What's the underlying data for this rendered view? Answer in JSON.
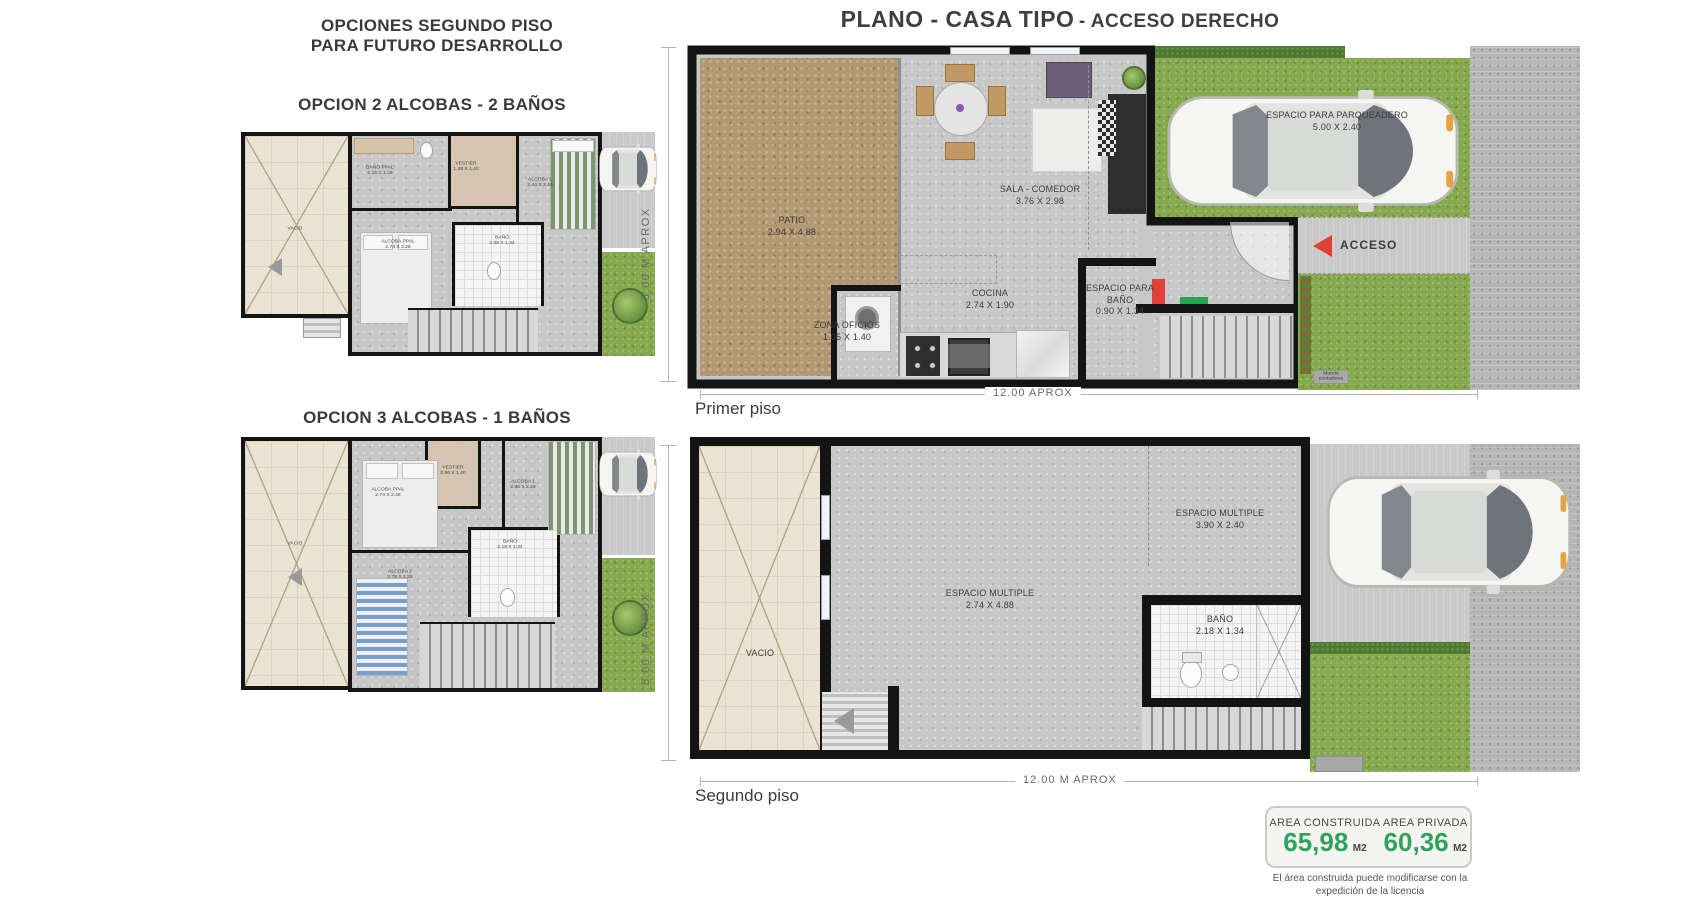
{
  "title": {
    "main": "PLANO - CASA TIPO",
    "sub": "- ACCESO DERECHO"
  },
  "left_panel": {
    "header_line1": "OPCIONES SEGUNDO PISO",
    "header_line2": "PARA FUTURO DESARROLLO",
    "option1": {
      "title": "OPCION 2 ALCOBAS - 2 BAÑOS",
      "rooms": {
        "vacio": {
          "name": "VACIO"
        },
        "bano_ppal": {
          "name": "BAÑO PPAL",
          "dims": "2.16 X 1.28"
        },
        "vestier": {
          "name": "VESTIER",
          "dims": "1.48 X 1.40"
        },
        "alcoba1": {
          "name": "ALCOBA 1",
          "dims": "2.44 X 2.49"
        },
        "alcoba_ppal": {
          "name": "ALCOBA PPAL",
          "dims": "2.74 X 3.28"
        },
        "bano": {
          "name": "BAÑO",
          "dims": "2.08 X 1.34"
        }
      }
    },
    "option2": {
      "title": "OPCION 3 ALCOBAS - 1 BAÑOS",
      "rooms": {
        "vacio": {
          "name": "VACIO"
        },
        "alcoba_ppal": {
          "name": "ALCOBA PPAL",
          "dims": "2.74 X 2.48"
        },
        "vestier": {
          "name": "VESTIER",
          "dims": "0.96 X 1.40"
        },
        "alcoba1": {
          "name": "ALCOBA 1",
          "dims": "2.85 X 2.49"
        },
        "alcoba2": {
          "name": "ALCOBA 2",
          "dims": "2.79 X 2.28"
        },
        "bano": {
          "name": "BAÑO",
          "dims": "2.18 X 1.34"
        }
      }
    }
  },
  "floor1": {
    "label": "Primer piso",
    "dim_horizontal": "12.00 APROX",
    "dim_vertical": "5.00 M APROX",
    "rooms": {
      "patio": {
        "name": "PATIO",
        "dims": "2.94 X 4.88"
      },
      "sala_comedor": {
        "name": "SALA - COMEDOR",
        "dims": "3.76 X 2.98"
      },
      "cocina": {
        "name": "COCINA",
        "dims": "2.74 X 1.90"
      },
      "zona_oficios": {
        "name": "ZONA OFICIOS",
        "dims": "1.05 X 1.40"
      },
      "espacio_bano": {
        "name": "ESPACIO PARA BAÑO",
        "dims": "0.90 X 1.34"
      },
      "parqueadero": {
        "name": "ESPACIO PARA PARQUEADERO",
        "dims": "5.00 X 2.40"
      }
    },
    "acceso_label": "ACCESO",
    "murete_label": "Murete contadores"
  },
  "floor2": {
    "label": "Segundo piso",
    "dim_horizontal": "12.00 M APROX",
    "dim_vertical": "5.00 M APROX",
    "rooms": {
      "vacio": {
        "name": "VACIO"
      },
      "espacio_multiple_1": {
        "name": "ESPACIO MULTIPLE",
        "dims": "2.74 X 4.88"
      },
      "espacio_multiple_2": {
        "name": "ESPACIO MULTIPLE",
        "dims": "3.90 X 2.40"
      },
      "bano": {
        "name": "BAÑO",
        "dims": "2.18 X 1.34"
      }
    }
  },
  "area_summary": {
    "construida_label": "AREA CONSTRUIDA",
    "construida_value": "65,98",
    "construida_unit": "M2",
    "privada_label": "AREA  PRIVADA",
    "privada_value": "60,36",
    "privada_unit": "M2",
    "note_line1": "El área construida puede modificarse con la",
    "note_line2": "expedición de la licencia"
  },
  "colors": {
    "accent_red": "#df4038",
    "accent_green": "#28a455",
    "value_green": "#2fa25c",
    "grass": "#85a94d",
    "patio_brown": "#b39873"
  }
}
